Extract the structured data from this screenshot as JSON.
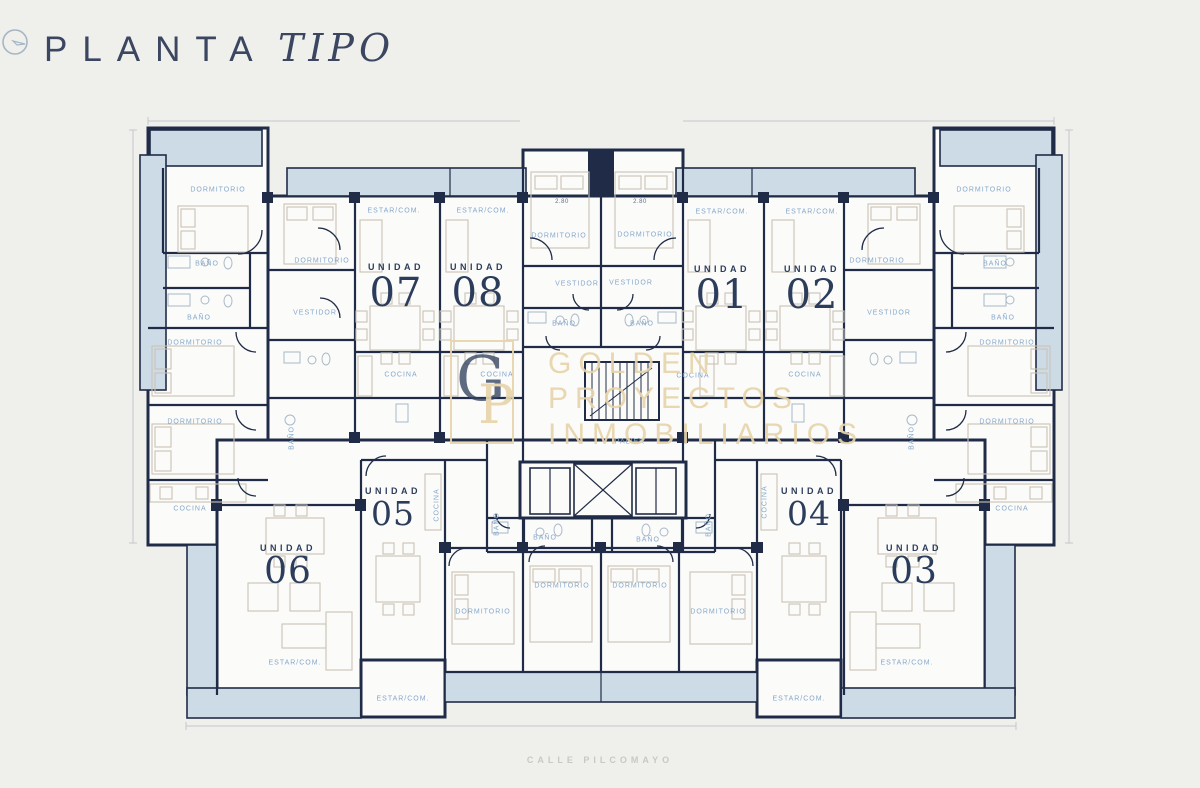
{
  "page": {
    "title_regular": "PLANTA",
    "title_italic": "TIPO",
    "street_label": "CALLE PILCOMAYO"
  },
  "colors": {
    "background": "#efefec",
    "wall_navy": "#202c47",
    "balcony_blue": "#cddbe7",
    "room_label_blue": "#84a8ca",
    "unit_navy": "#2c3d5c",
    "watermark_gold": "#e7d4aa"
  },
  "icons": {
    "compass": "north-compass-icon"
  },
  "watermark": {
    "monogram_g": "G",
    "monogram_p": "P",
    "lines": [
      "GOLDEN",
      "PROYECTOS",
      "INMOBILIARIOS"
    ]
  },
  "plan": {
    "units": [
      {
        "prefix": "UNIDAD",
        "number": "07",
        "x": 396,
        "y": 263,
        "size": "lg"
      },
      {
        "prefix": "UNIDAD",
        "number": "08",
        "x": 478,
        "y": 263,
        "size": "lg"
      },
      {
        "prefix": "UNIDAD",
        "number": "01",
        "x": 722,
        "y": 265,
        "size": "lg"
      },
      {
        "prefix": "UNIDAD",
        "number": "02",
        "x": 812,
        "y": 265,
        "size": "lg"
      },
      {
        "prefix": "UNIDAD",
        "number": "05",
        "x": 393,
        "y": 487,
        "size": "sm"
      },
      {
        "prefix": "UNIDAD",
        "number": "06",
        "x": 288,
        "y": 544,
        "size": "md"
      },
      {
        "prefix": "UNIDAD",
        "number": "04",
        "x": 809,
        "y": 487,
        "size": "sm"
      },
      {
        "prefix": "UNIDAD",
        "number": "03",
        "x": 914,
        "y": 544,
        "size": "md"
      }
    ],
    "room_labels": [
      {
        "text": "DORMITORIO",
        "x": 218,
        "y": 190
      },
      {
        "text": "BAÑO",
        "x": 207,
        "y": 264
      },
      {
        "text": "BAÑO",
        "x": 199,
        "y": 318
      },
      {
        "text": "DORMITORIO",
        "x": 195,
        "y": 343
      },
      {
        "text": "DORMITORIO",
        "x": 195,
        "y": 422
      },
      {
        "text": "COCINA",
        "x": 190,
        "y": 509
      },
      {
        "text": "DORMITORIO",
        "x": 322,
        "y": 261
      },
      {
        "text": "VESTIDOR",
        "x": 315,
        "y": 313
      },
      {
        "text": "BAÑO",
        "x": 292,
        "y": 438,
        "vertical": true
      },
      {
        "text": "ESTAR/COM.",
        "x": 394,
        "y": 211
      },
      {
        "text": "ESTAR/COM.",
        "x": 483,
        "y": 211
      },
      {
        "text": "COCINA",
        "x": 401,
        "y": 375
      },
      {
        "text": "COCINA",
        "x": 497,
        "y": 375
      },
      {
        "text": "DORMITORIO",
        "x": 559,
        "y": 236
      },
      {
        "text": "DORMITORIO",
        "x": 645,
        "y": 235
      },
      {
        "text": "VESTIDOR",
        "x": 577,
        "y": 284
      },
      {
        "text": "VESTIDOR",
        "x": 631,
        "y": 283
      },
      {
        "text": "BAÑO",
        "x": 564,
        "y": 324
      },
      {
        "text": "BAÑO",
        "x": 642,
        "y": 324
      },
      {
        "text": "PALIER",
        "x": 630,
        "y": 442
      },
      {
        "text": "BAÑO",
        "x": 545,
        "y": 538
      },
      {
        "text": "BAÑO",
        "x": 648,
        "y": 540
      },
      {
        "text": "BAÑO",
        "x": 497,
        "y": 524,
        "vertical": true
      },
      {
        "text": "BAÑO",
        "x": 709,
        "y": 525,
        "vertical": true
      },
      {
        "text": "COCINA",
        "x": 437,
        "y": 505,
        "vertical": true
      },
      {
        "text": "COCINA",
        "x": 765,
        "y": 502,
        "vertical": true
      },
      {
        "text": "ESTAR/COM.",
        "x": 722,
        "y": 212
      },
      {
        "text": "ESTAR/COM.",
        "x": 812,
        "y": 212
      },
      {
        "text": "COCINA",
        "x": 693,
        "y": 376
      },
      {
        "text": "COCINA",
        "x": 805,
        "y": 375
      },
      {
        "text": "DORMITORIO",
        "x": 877,
        "y": 261
      },
      {
        "text": "VESTIDOR",
        "x": 889,
        "y": 313
      },
      {
        "text": "BAÑO",
        "x": 912,
        "y": 438,
        "vertical": true
      },
      {
        "text": "DORMITORIO",
        "x": 984,
        "y": 190
      },
      {
        "text": "BAÑO",
        "x": 995,
        "y": 264
      },
      {
        "text": "BAÑO",
        "x": 1003,
        "y": 318
      },
      {
        "text": "DORMITORIO",
        "x": 1007,
        "y": 343
      },
      {
        "text": "DORMITORIO",
        "x": 1007,
        "y": 422
      },
      {
        "text": "COCINA",
        "x": 1012,
        "y": 509
      },
      {
        "text": "DORMITORIO",
        "x": 483,
        "y": 612
      },
      {
        "text": "DORMITORIO",
        "x": 562,
        "y": 586
      },
      {
        "text": "DORMITORIO",
        "x": 640,
        "y": 586
      },
      {
        "text": "DORMITORIO",
        "x": 718,
        "y": 612
      },
      {
        "text": "ESTAR/COM.",
        "x": 295,
        "y": 663
      },
      {
        "text": "ESTAR/COM.",
        "x": 403,
        "y": 699
      },
      {
        "text": "ESTAR/COM.",
        "x": 799,
        "y": 699
      },
      {
        "text": "ESTAR/COM.",
        "x": 907,
        "y": 663
      }
    ],
    "dimension_labels": [
      {
        "text": "2.80",
        "x": 562,
        "y": 202
      },
      {
        "text": "2.80",
        "x": 640,
        "y": 202
      }
    ]
  }
}
